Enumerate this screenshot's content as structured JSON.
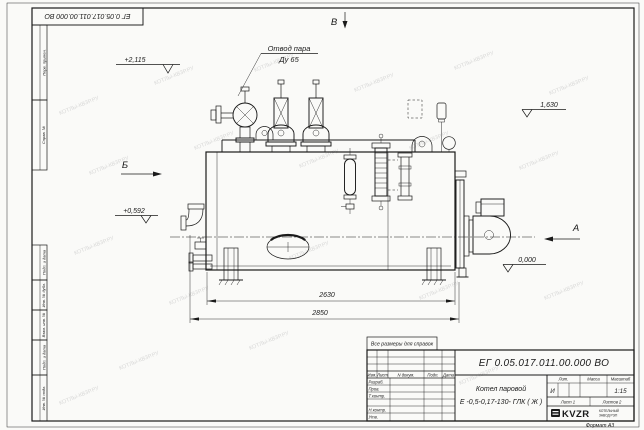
{
  "watermark": {
    "text": "КОТЛЫ-КВЗР.РУ"
  },
  "frame": {
    "top_stamp": "ЕГ 0.05.017.011.00.000  ВО",
    "margin_labels": [
      "Перв. примен.",
      "Справ. №",
      "Подп. и дата",
      "Инв. № дубл.",
      "Взам. инв. №",
      "Подп. и дата",
      "Инв. № подл."
    ],
    "format_note": "Формат А3"
  },
  "drawing": {
    "callout": {
      "line1": "Отвод пара",
      "line2": "Ду 65"
    },
    "views": {
      "top": "В",
      "left": "Б",
      "right": "А"
    },
    "elevations": {
      "valve_top": "+2,115",
      "shell_top": "1,630",
      "burner_axis": "+0,592",
      "ground": "0,000"
    },
    "dimensions": {
      "shell_length": "2630",
      "overall_length": "2850"
    }
  },
  "title_block": {
    "note": "Все размеры для справок",
    "doc_number": "ЕГ 0.05.017.011.00.000  ВО",
    "product_line1": "Котел паровой",
    "product_line2": "Е -0,5-0,17-130- ГЛК ( Ж )",
    "columns": {
      "izm": "Изм.",
      "list": "Лист",
      "doc": "N докум.",
      "sign": "Подп.",
      "date": "Дата"
    },
    "roles": {
      "developed": "Разраб.",
      "checked": "Пров.",
      "tcontrol": "Т.контр.",
      "ncontrol": "Н.контр.",
      "approved": "Утв."
    },
    "lit": {
      "header": "Лит.",
      "value": "И"
    },
    "mass": {
      "header": "Масса"
    },
    "scale": {
      "header": "Масштаб",
      "value": "1:15"
    },
    "sheet": "Лист  1",
    "sheets": "Листов  2",
    "company": {
      "logo": "KVZR",
      "sub1": "КОТЕЛЬНЫЙ",
      "sub2": "ЗАВОД РЭП"
    }
  }
}
